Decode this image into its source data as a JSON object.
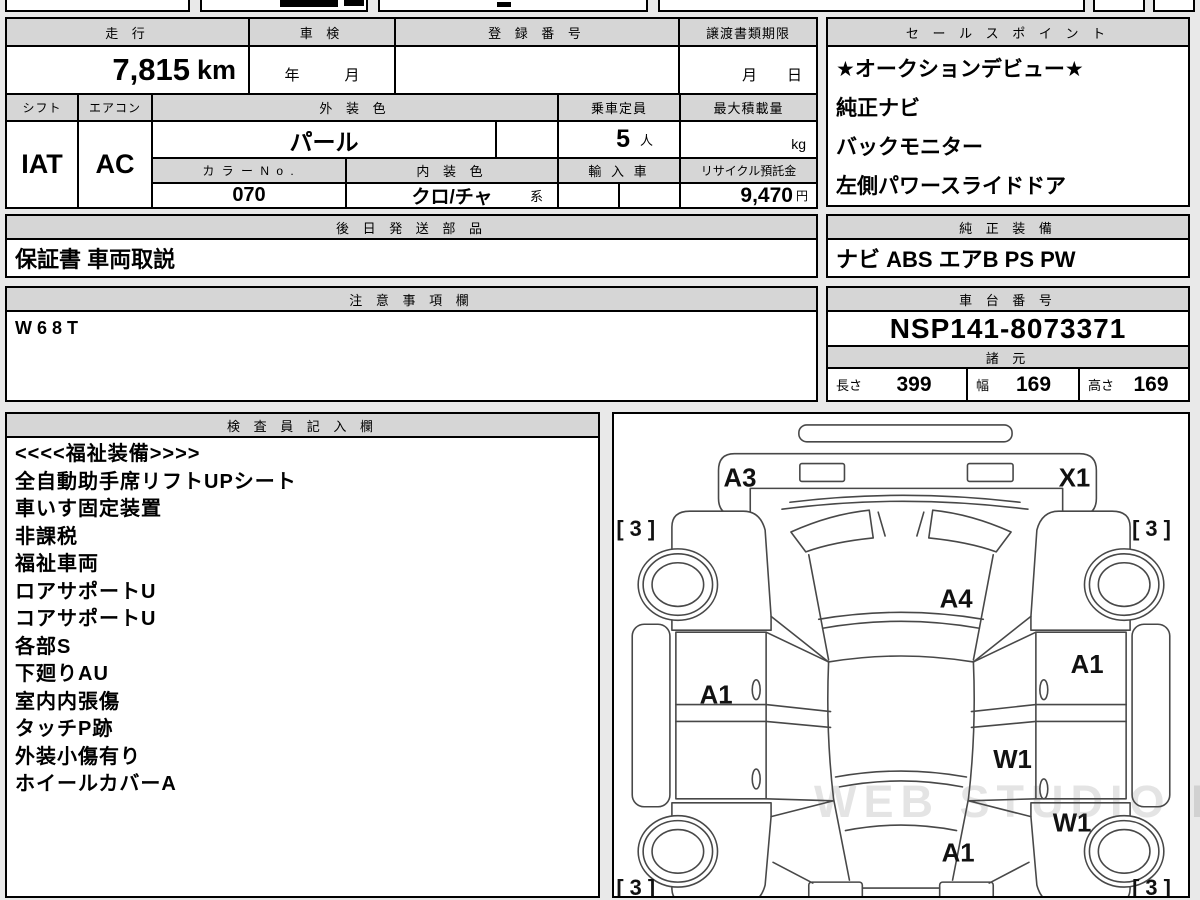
{
  "meta": {
    "page_bg": "#e9e9e9",
    "header_bg": "#d6d6d6",
    "border_color": "#000000"
  },
  "main_table": {
    "headers": {
      "mileage": "走 行",
      "inspection": "車 検",
      "registration": "登 録 番 号",
      "transfer_docs": "譲渡書類期限",
      "shift": "シフト",
      "aircon": "エアコン",
      "exterior_color": "外 装 色",
      "capacity": "乗車定員",
      "max_load": "最大積載量",
      "color_no": "カ ラ ー N o .",
      "interior_color": "内 装 色",
      "import_car": "輸 入 車",
      "recycle_deposit": "リサイクル預託金",
      "later_parts": "後 日 発 送 部 品",
      "notes": "注 意 事 項 欄"
    },
    "values": {
      "mileage": "7,815",
      "mileage_unit": "km",
      "inspection": "年　　　月",
      "registration": "",
      "transfer_docs": "月　　日",
      "shift": "IAT",
      "aircon": "AC",
      "exterior_color": "パール",
      "capacity": "5",
      "capacity_unit": "人",
      "max_load_unit": "kg",
      "color_no": "070",
      "interior_color": "クロ/チャ",
      "interior_color_suffix": "系",
      "recycle_deposit": "9,470",
      "recycle_unit": "円",
      "later_parts": "保証書 車両取説",
      "notes": "W68T"
    }
  },
  "sales_points": {
    "header": "セ ー ル ス ポ イ ン ト",
    "items": [
      "★オークションデビュー★",
      "純正ナビ",
      "バックモニター",
      "左側パワースライドドア"
    ]
  },
  "genuine_equipment": {
    "header": "純 正 装 備",
    "value": "ナビ  ABS  エアB  PS  PW"
  },
  "chassis": {
    "header": "車 台 番 号",
    "value": "NSP141-8073371"
  },
  "specs": {
    "header": "諸 元",
    "length_label": "長さ",
    "length": "399",
    "width_label": "幅",
    "width": "169",
    "height_label": "高さ",
    "height": "169"
  },
  "inspector": {
    "header": "検 査 員 記 入 欄",
    "lines": [
      "<<<<福祉装備>>>>",
      "全自動助手席リフトUPシート",
      "車いす固定装置",
      "非課税",
      "福祉車両",
      "ロアサポートU",
      "コアサポートU",
      "各部S",
      "下廻りAU",
      "室内内張傷",
      "タッチP跡",
      "外装小傷有り",
      "ホイールカバーA"
    ]
  },
  "diagram": {
    "labels": [
      "A3",
      "X1",
      "[ 3 ]",
      "[ 3 ]",
      "A4",
      "A1",
      "A1",
      "W1",
      "W1",
      "A1",
      "[ 3 ]",
      "[ 3 ]"
    ],
    "watermark": "WEB STUDIO PRO"
  }
}
